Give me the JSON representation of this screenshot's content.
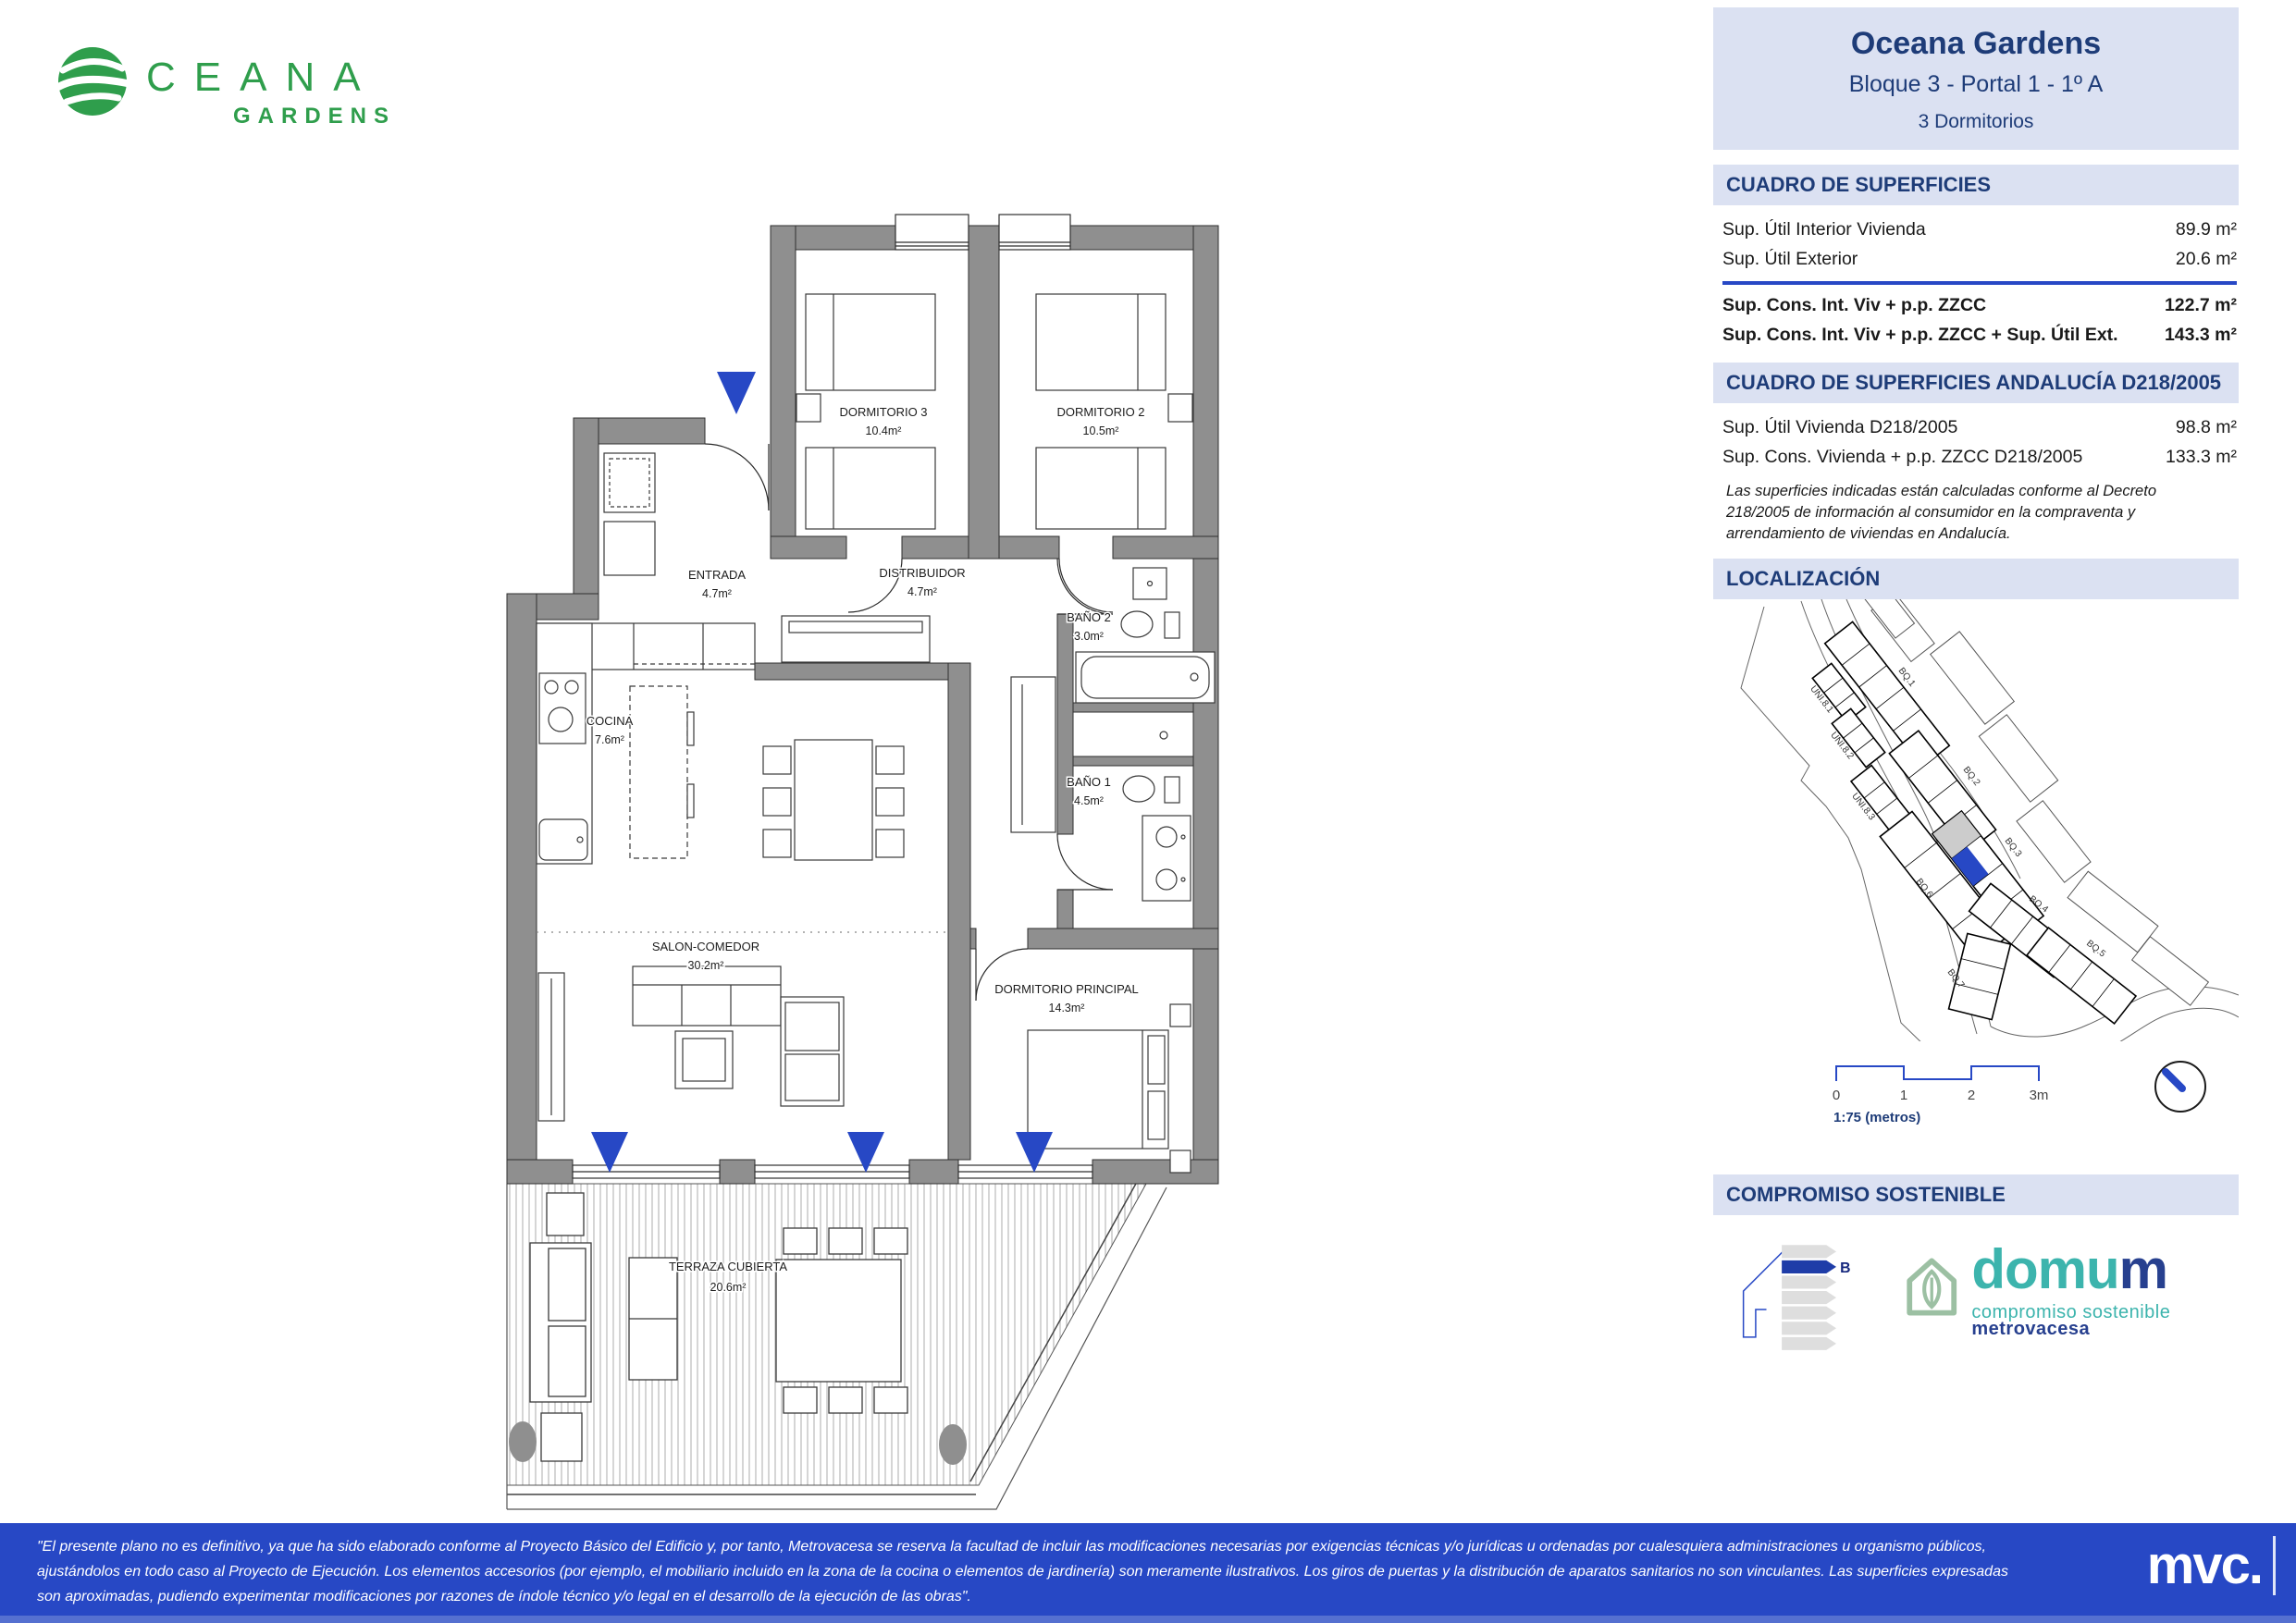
{
  "brand": {
    "logo_word": "CEANA",
    "logo_sub": "GARDENS"
  },
  "plan": {
    "rooms": [
      {
        "name": "DORMITORIO 3",
        "area": "10.4m²"
      },
      {
        "name": "DORMITORIO 2",
        "area": "10.5m²"
      },
      {
        "name": "ENTRADA",
        "area": "4.7m²"
      },
      {
        "name": "DISTRIBUIDOR",
        "area": "4.7m²"
      },
      {
        "name": "BAÑO 2",
        "area": "3.0m²"
      },
      {
        "name": "BAÑO 1",
        "area": "4.5m²"
      },
      {
        "name": "COCINA",
        "area": "7.6m²"
      },
      {
        "name": "SALON-COMEDOR",
        "area": "30.2m²"
      },
      {
        "name": "DORMITORIO PRINCIPAL",
        "area": "14.3m²"
      },
      {
        "name": "TERRAZA CUBIERTA",
        "area": "20.6m²"
      }
    ]
  },
  "panel": {
    "title": "Oceana Gardens",
    "subtitle": "Bloque 3 - Portal 1 - 1º A",
    "dormitorios": "3 Dormitorios",
    "surfaces": {
      "heading": "CUADRO DE SUPERFICIES",
      "rows": [
        {
          "label": "Sup. Útil Interior Vivienda",
          "value": "89.9 m²"
        },
        {
          "label": "Sup. Útil Exterior",
          "value": "20.6 m²"
        }
      ],
      "totals": [
        {
          "label": "Sup. Cons. Int. Viv + p.p. ZZCC",
          "value": "122.7 m²"
        },
        {
          "label": "Sup. Cons. Int. Viv + p.p. ZZCC + Sup. Útil Ext.",
          "value": "143.3 m²"
        }
      ]
    },
    "andalucia": {
      "heading": "CUADRO DE SUPERFICIES ANDALUCÍA D218/2005",
      "rows": [
        {
          "label": "Sup. Útil Vivienda D218/2005",
          "value": "98.8 m²"
        },
        {
          "label": "Sup. Cons. Vivienda + p.p. ZZCC D218/2005",
          "value": "133.3 m²"
        }
      ],
      "note": "Las superficies indicadas están calculadas conforme al Decreto 218/2005 de información al consumidor en la compraventa y arrendamiento de viviendas en Andalucía."
    },
    "localizacion": {
      "heading": "LOCALIZACIÓN",
      "blocks": [
        "BQ.1",
        "BQ.2",
        "BQ.3",
        "BQ.4",
        "BQ.5",
        "BQ.6",
        "BQ.7"
      ],
      "units": [
        "UNI.8.1",
        "UNI.8.2",
        "UNI.8.3"
      ],
      "scale_ticks": [
        "0",
        "1",
        "2",
        "3m"
      ],
      "scale_caption": "1:75 (metros)"
    },
    "sostenible": {
      "heading": "COMPROMISO SOSTENIBLE",
      "energy_rating": "B",
      "domum_word_teal": "domu",
      "domum_word_navy": "m",
      "tagline_teal": "compromiso sostenible",
      "tagline_navy": "metrovacesa"
    }
  },
  "footer": {
    "lines": [
      "\"El presente plano no es definitivo, ya que ha sido elaborado conforme al Proyecto Básico del Edificio y, por tanto, Metrovacesa se reserva la facultad de incluir las modificaciones necesarias por exigencias técnicas y/o jurídicas u ordenadas por cualesquiera administraciones u organismo públicos,",
      "ajustándolos en todo caso al Proyecto de Ejecución. Los elementos accesorios (por ejemplo, el mobiliario incluido en la zona de la cocina o elementos de jardinería) son meramente ilustrativos. Los giros de puertas y la distribución de aparatos sanitarios no son vinculantes. Las superficies expresadas",
      "son aproximadas, pudiendo experimentar modificaciones por razones de índole técnico y/o legal en el desarrollo de la ejecución de las obras\"."
    ],
    "logo": "mvc."
  },
  "colors": {
    "accent_blue": "#2748c5",
    "navy": "#1e3c78",
    "panel_bg": "#dbe1f2",
    "wall_gray": "#8f8f8f",
    "brand_green": "#2f9e4c",
    "teal": "#3cb4ad",
    "sage": "#9cc0a3",
    "highlight_unit": "#2748c5",
    "neighbor_unit": "#cccccc"
  }
}
